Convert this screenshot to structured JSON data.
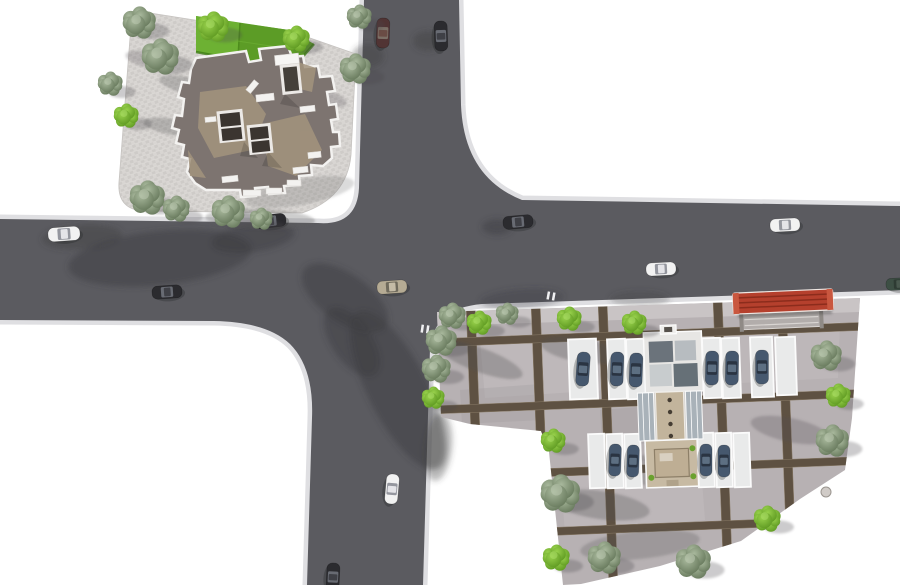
{
  "scene": {
    "description": "Aerial 3D render of a site plan: road intersection, corner office building with lawn plaza, residential block with parking courts",
    "canvas": {
      "width": 900,
      "height": 585
    },
    "palette": {
      "background": "#ffffff",
      "asphalt": "#5b5b60",
      "curb": "#dfdfe2",
      "road_shadow": "#3b3c40",
      "plaza_light": "#d8d5d2",
      "plaza_dark": "#cecbc8",
      "lawn_base": "#63a52c",
      "lawn_light": "#6db133",
      "lawn_dark": "#5c9c26",
      "roof_base": "#7d7470",
      "roof_tan": "#a3947d",
      "roof_white": "#f3f2f0",
      "skylight_dark": "#3b3530",
      "site_paving": "#b7b1b3",
      "site_sidewalk": "#c9c4c5",
      "grid_strip": "#5e5142",
      "stall_white": "#e9eaea",
      "canopy_red": "#b5402d",
      "tree_bright_hi": "#98d14c",
      "tree_bright_lo": "#5f9a22",
      "tree_grey_hi": "#a8b89c",
      "tree_grey_lo": "#67795c",
      "car_white": "#f2f2f2",
      "car_black": "#2b2b2f",
      "car_tan": "#b5ab94",
      "car_maroon": "#513434",
      "car_blue": "#46586e",
      "car_green": "#3d4f44"
    },
    "street_cars": [
      {
        "x": 383,
        "y": 33,
        "rot": 92,
        "len": 30,
        "wid": 13,
        "color": "maroon"
      },
      {
        "x": 441,
        "y": 36,
        "rot": 88,
        "len": 30,
        "wid": 13,
        "color": "black"
      },
      {
        "x": 64,
        "y": 234,
        "rot": -4,
        "len": 32,
        "wid": 14,
        "color": "white"
      },
      {
        "x": 270,
        "y": 221,
        "rot": -6,
        "len": 32,
        "wid": 13,
        "color": "black"
      },
      {
        "x": 167,
        "y": 292,
        "rot": -4,
        "len": 30,
        "wid": 13,
        "color": "black"
      },
      {
        "x": 392,
        "y": 287,
        "rot": -4,
        "len": 30,
        "wid": 13,
        "color": "tan"
      },
      {
        "x": 518,
        "y": 222,
        "rot": -5,
        "len": 30,
        "wid": 13,
        "color": "black"
      },
      {
        "x": 661,
        "y": 269,
        "rot": -3,
        "len": 30,
        "wid": 13,
        "color": "white"
      },
      {
        "x": 785,
        "y": 225,
        "rot": -3,
        "len": 30,
        "wid": 13,
        "color": "white"
      },
      {
        "x": 392,
        "y": 489,
        "rot": 95,
        "len": 30,
        "wid": 13,
        "color": "white"
      },
      {
        "x": 333,
        "y": 577,
        "rot": 93,
        "len": 28,
        "wid": 13,
        "color": "black"
      },
      {
        "x": 899,
        "y": 284,
        "rot": -3,
        "len": 26,
        "wid": 12,
        "color": "green"
      }
    ],
    "parked_cars": [
      {
        "x": 583,
        "y": 369,
        "rot": 94,
        "len": 34,
        "wid": 13
      },
      {
        "x": 617,
        "y": 369,
        "rot": 92,
        "len": 34,
        "wid": 13
      },
      {
        "x": 636,
        "y": 370,
        "rot": 92,
        "len": 34,
        "wid": 13
      },
      {
        "x": 712,
        "y": 368,
        "rot": 91,
        "len": 34,
        "wid": 13
      },
      {
        "x": 732,
        "y": 368,
        "rot": 91,
        "len": 34,
        "wid": 13
      },
      {
        "x": 762,
        "y": 367,
        "rot": 90,
        "len": 34,
        "wid": 13
      },
      {
        "x": 615,
        "y": 460,
        "rot": 92,
        "len": 32,
        "wid": 12
      },
      {
        "x": 633,
        "y": 461,
        "rot": 92,
        "len": 32,
        "wid": 12
      },
      {
        "x": 706,
        "y": 460,
        "rot": 90,
        "len": 32,
        "wid": 12
      },
      {
        "x": 724,
        "y": 461,
        "rot": 90,
        "len": 32,
        "wid": 12
      }
    ],
    "stalls": [
      {
        "x": 583,
        "y": 369,
        "w": 28,
        "h": 60,
        "rot": -2
      },
      {
        "x": 617,
        "y": 369,
        "w": 18,
        "h": 60,
        "rot": -2
      },
      {
        "x": 636,
        "y": 369,
        "w": 18,
        "h": 60,
        "rot": -2
      },
      {
        "x": 712,
        "y": 368,
        "w": 18,
        "h": 60,
        "rot": -2
      },
      {
        "x": 731,
        "y": 368,
        "w": 18,
        "h": 60,
        "rot": -2
      },
      {
        "x": 762,
        "y": 367,
        "w": 22,
        "h": 60,
        "rot": -2
      },
      {
        "x": 786,
        "y": 366,
        "w": 20,
        "h": 58,
        "rot": -2
      },
      {
        "x": 597,
        "y": 461,
        "w": 16,
        "h": 54,
        "rot": -2
      },
      {
        "x": 615,
        "y": 461,
        "w": 16,
        "h": 54,
        "rot": -2
      },
      {
        "x": 633,
        "y": 461,
        "w": 16,
        "h": 54,
        "rot": -2
      },
      {
        "x": 706,
        "y": 460,
        "w": 16,
        "h": 54,
        "rot": -2
      },
      {
        "x": 724,
        "y": 460,
        "w": 16,
        "h": 54,
        "rot": -2
      },
      {
        "x": 742,
        "y": 460,
        "w": 16,
        "h": 54,
        "rot": -2
      }
    ],
    "trees": [
      {
        "x": 139,
        "y": 23,
        "r": 16,
        "t": "g"
      },
      {
        "x": 160,
        "y": 57,
        "r": 18,
        "t": "g"
      },
      {
        "x": 110,
        "y": 84,
        "r": 12,
        "t": "g"
      },
      {
        "x": 126,
        "y": 116,
        "r": 12,
        "t": "b"
      },
      {
        "x": 147,
        "y": 198,
        "r": 17,
        "t": "g"
      },
      {
        "x": 176,
        "y": 209,
        "r": 13,
        "t": "g"
      },
      {
        "x": 228,
        "y": 212,
        "r": 16,
        "t": "g"
      },
      {
        "x": 261,
        "y": 219,
        "r": 11,
        "t": "g"
      },
      {
        "x": 355,
        "y": 69,
        "r": 15,
        "t": "g"
      },
      {
        "x": 359,
        "y": 17,
        "r": 12,
        "t": "g"
      },
      {
        "x": 213,
        "y": 27,
        "r": 15,
        "t": "b"
      },
      {
        "x": 296,
        "y": 39,
        "r": 13,
        "t": "b"
      },
      {
        "x": 452,
        "y": 316,
        "r": 13,
        "t": "g"
      },
      {
        "x": 507,
        "y": 314,
        "r": 11,
        "t": "g"
      },
      {
        "x": 479,
        "y": 323,
        "r": 12,
        "t": "b"
      },
      {
        "x": 569,
        "y": 319,
        "r": 12,
        "t": "b"
      },
      {
        "x": 634,
        "y": 323,
        "r": 12,
        "t": "b"
      },
      {
        "x": 441,
        "y": 341,
        "r": 15,
        "t": "g"
      },
      {
        "x": 436,
        "y": 369,
        "r": 14,
        "t": "g"
      },
      {
        "x": 433,
        "y": 398,
        "r": 11,
        "t": "b"
      },
      {
        "x": 553,
        "y": 441,
        "r": 12,
        "t": "b"
      },
      {
        "x": 560,
        "y": 494,
        "r": 19,
        "t": "g"
      },
      {
        "x": 556,
        "y": 558,
        "r": 13,
        "t": "b"
      },
      {
        "x": 604,
        "y": 558,
        "r": 16,
        "t": "g"
      },
      {
        "x": 693,
        "y": 562,
        "r": 17,
        "t": "g"
      },
      {
        "x": 767,
        "y": 519,
        "r": 13,
        "t": "b"
      },
      {
        "x": 826,
        "y": 356,
        "r": 15,
        "t": "g"
      },
      {
        "x": 838,
        "y": 396,
        "r": 12,
        "t": "b"
      },
      {
        "x": 832,
        "y": 441,
        "r": 16,
        "t": "g"
      }
    ],
    "road_markings": [
      {
        "x": 551,
        "y": 296,
        "rot": 10
      },
      {
        "x": 425,
        "y": 329,
        "rot": 8
      }
    ],
    "manhole": {
      "x": 826,
      "y": 492,
      "r": 5
    }
  }
}
